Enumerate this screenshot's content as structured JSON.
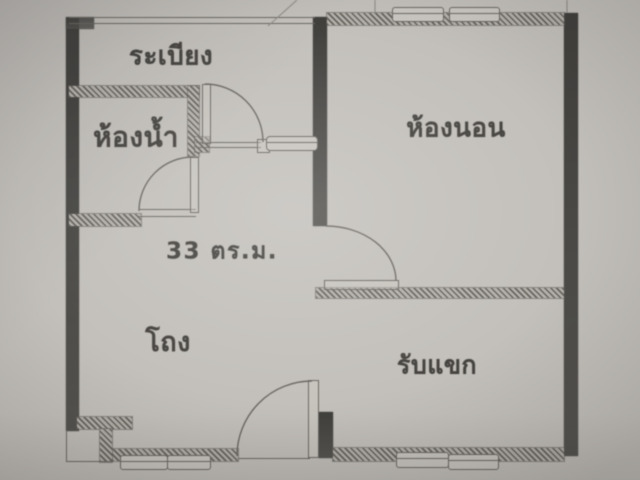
{
  "plan": {
    "area_label": "33 ตร.ม.",
    "rooms": {
      "balcony": {
        "label": "ระเบียง"
      },
      "bathroom": {
        "label": "ห้องน้ำ"
      },
      "bedroom": {
        "label": "ห้องนอน"
      },
      "hall": {
        "label": "โถง"
      },
      "living": {
        "label": "รับแขก"
      }
    },
    "colors": {
      "paper": "#c3c0bb",
      "wall_solid": "#403f3c",
      "wall_hatch_dark": "#67645f",
      "wall_hatch_light": "#b4b1ab",
      "line": "#6b6863",
      "text": "#45433f"
    }
  }
}
